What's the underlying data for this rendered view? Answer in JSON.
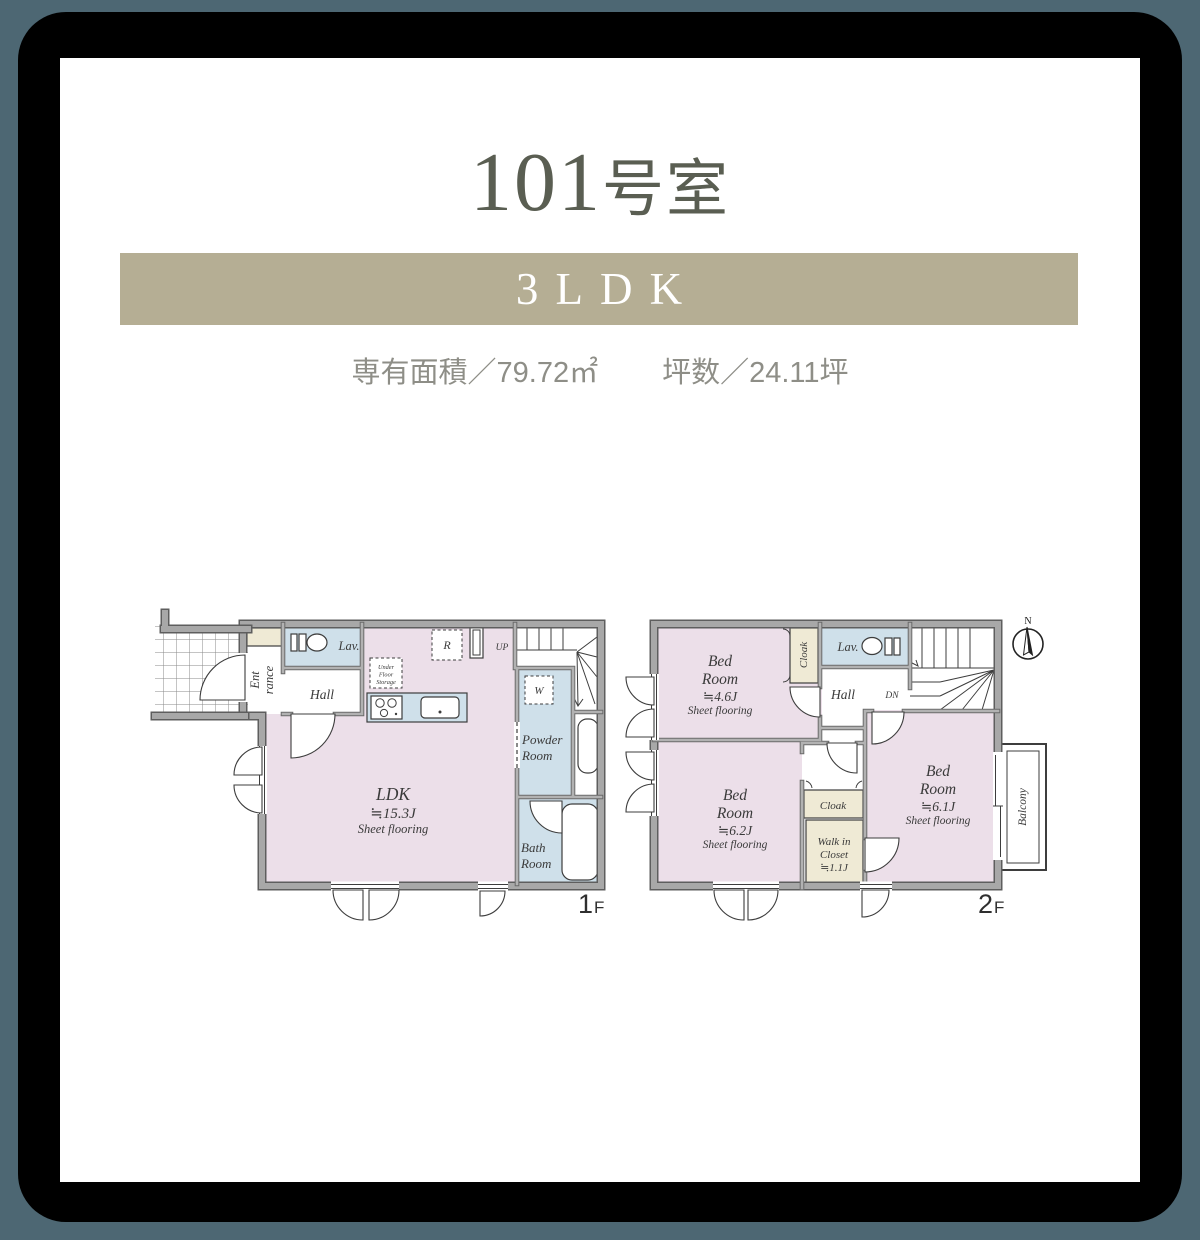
{
  "page": {
    "background_color": "#4d6773",
    "frame_color": "#000000",
    "card_color": "#ffffff"
  },
  "header": {
    "room_number": "101",
    "room_suffix": "号室",
    "banner": {
      "label": "3LDK",
      "color": "#b5ae94"
    },
    "specs": {
      "area": "専有面積／79.72㎡",
      "tsubo": "坪数／24.11坪"
    }
  },
  "palette": {
    "room_pink": "#ecdfe9",
    "room_blue": "#cfe0ea",
    "room_beige": "#efead5",
    "wall_gray": "#a8a8a8",
    "line_color": "#3d3d3d"
  },
  "floor1": {
    "floor_number": "1",
    "floor_suffix": "F",
    "labels": {
      "entrance_line1": "Ent",
      "entrance_line2": "rance",
      "hall": "Hall",
      "lavatory": "Lav.",
      "ldk_name": "LDK",
      "ldk_size": "≒15.3J",
      "ldk_flooring": "Sheet flooring",
      "under_floor_storage_line1": "Under",
      "under_floor_storage_line2": "Floor",
      "under_floor_storage_line3": "Storage",
      "refrigerator": "R",
      "washer": "W",
      "stairs_up": "UP",
      "powder_line1": "Powder",
      "powder_line2": "Room",
      "bath_line1": "Bath",
      "bath_line2": "Room"
    }
  },
  "floor2": {
    "floor_number": "2",
    "floor_suffix": "F",
    "labels": {
      "bedroom1_line1": "Bed",
      "bedroom1_line2": "Room",
      "bedroom1_size": "≒4.6J",
      "bedroom1_flooring": "Sheet flooring",
      "bedroom2_line1": "Bed",
      "bedroom2_line2": "Room",
      "bedroom2_size": "≒6.2J",
      "bedroom2_flooring": "Sheet flooring",
      "bedroom3_line1": "Bed",
      "bedroom3_line2": "Room",
      "bedroom3_size": "≒6.1J",
      "bedroom3_flooring": "Sheet flooring",
      "cloak_top": "Cloak",
      "cloak_middle": "Cloak",
      "wic_line1": "Walk in",
      "wic_line2": "Closet",
      "wic_line3": "≒1.1J",
      "hall": "Hall",
      "lavatory": "Lav.",
      "stairs_down": "DN",
      "balcony": "Balcony",
      "compass_north": "N"
    }
  }
}
